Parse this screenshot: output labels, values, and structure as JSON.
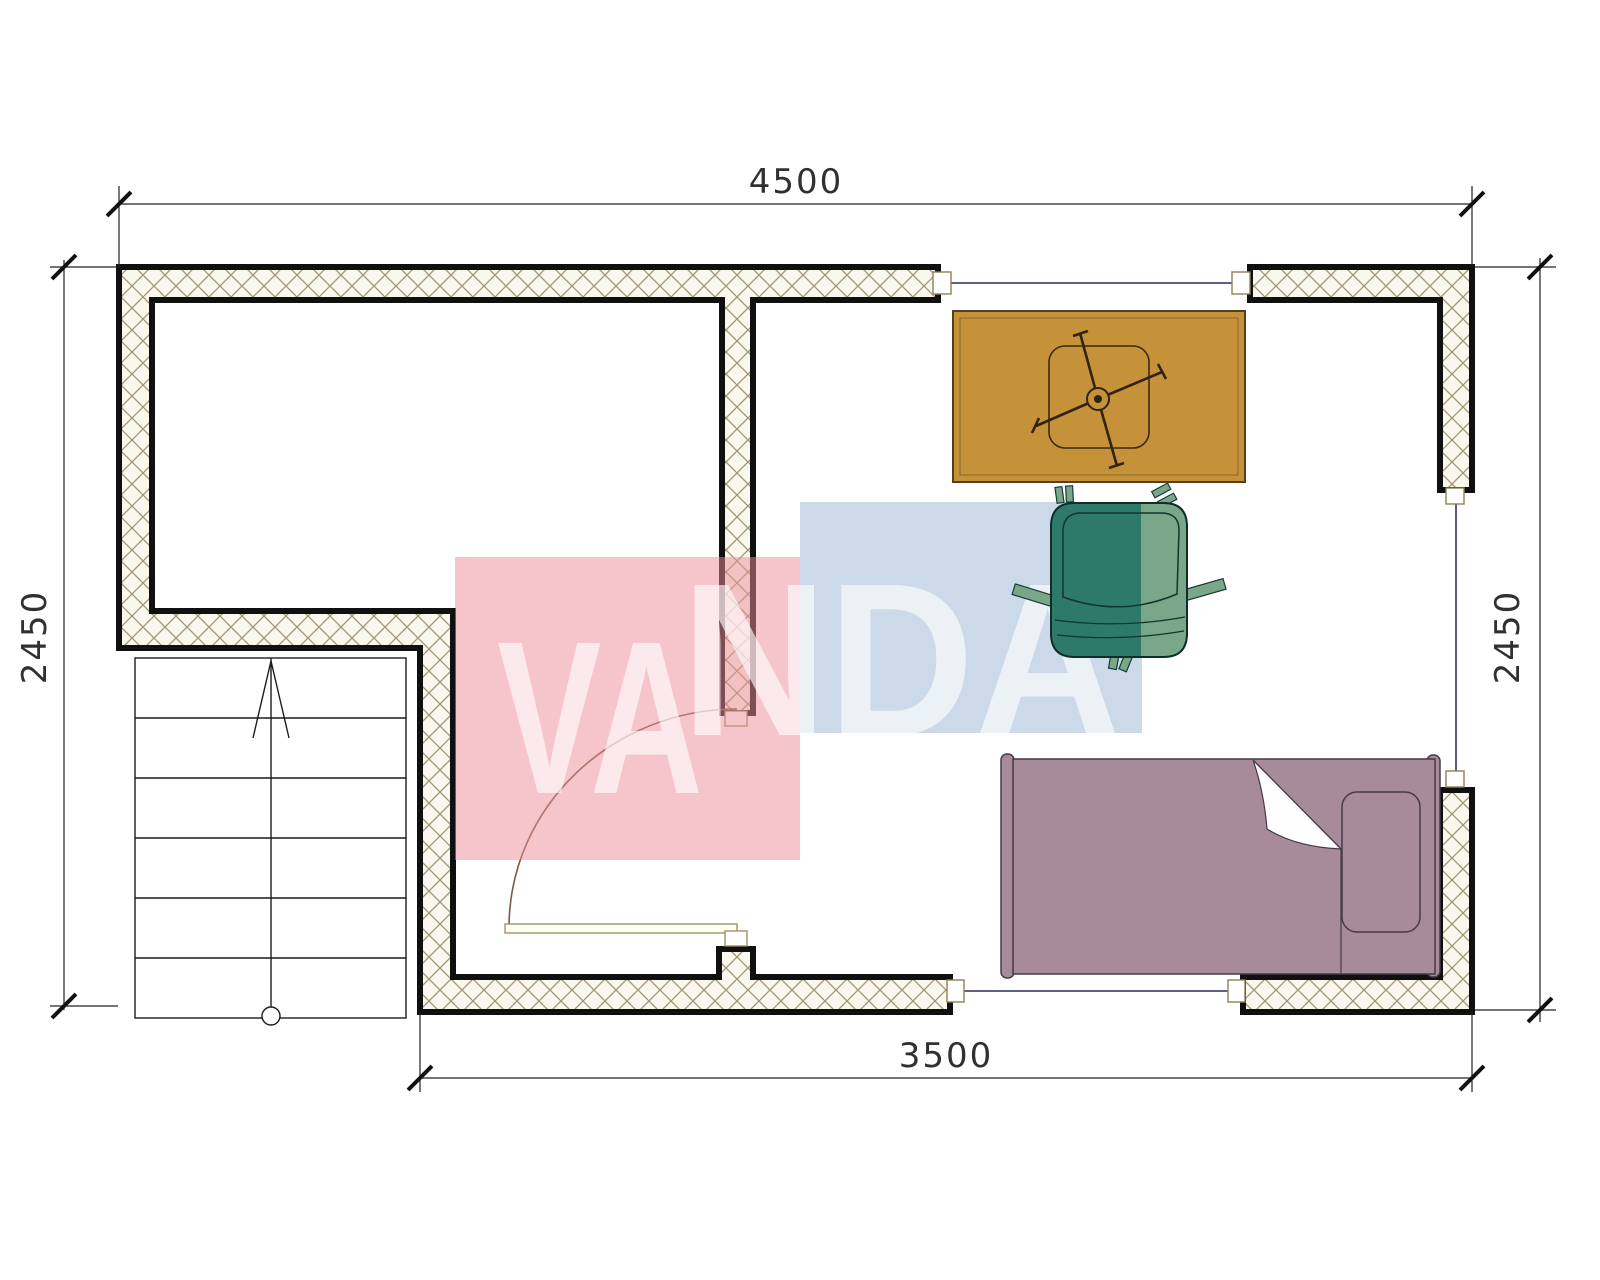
{
  "dimensions": {
    "top": "4500",
    "bottom": "3500",
    "left": "2450",
    "right": "2450"
  },
  "watermark": {
    "text": "VANDA",
    "segment1": "VA",
    "segment2": "NDA",
    "red_block_color": "#ed8c98",
    "blue_block_color": "#9ab4d2"
  },
  "palette": {
    "wall_fill": "#faf7ee",
    "wall_hatch_line": "#a09673",
    "wall_outline": "#101010",
    "window_line": "#4a4a72",
    "window_cap_stroke": "#8f7f55",
    "door_arc": "#7a5a40",
    "table_fill": "#c5923a",
    "chair_dark": "#2e7a6a",
    "chair_light": "#7aa689",
    "bed_fill": "#a78b98",
    "bed_outline": "#463a47",
    "stair_line": "#1c1c1c",
    "dimension_line": "#222222"
  },
  "elements": {
    "staircase": {
      "treads": 6,
      "direction_arrow": "up"
    },
    "windows": 3,
    "door": {
      "type": "single-swing"
    },
    "furniture": [
      "table-with-desk-chair",
      "armchair",
      "single-bed"
    ]
  }
}
